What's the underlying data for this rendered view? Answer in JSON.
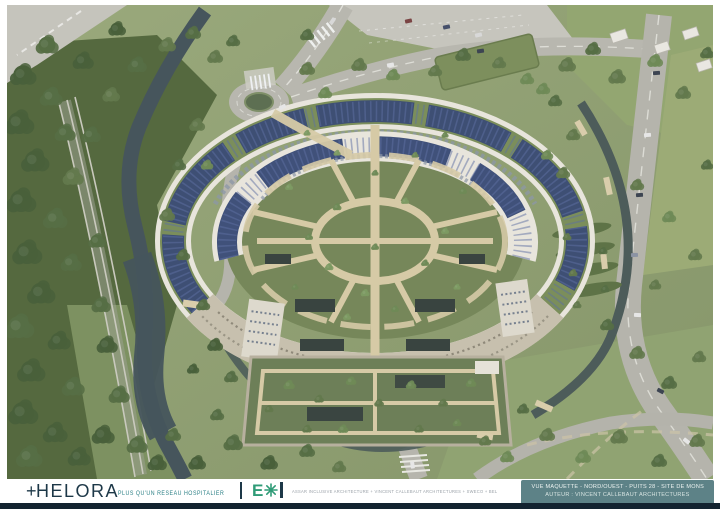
{
  "footer": {
    "helora": {
      "plus": "+",
      "name": "HELORA",
      "tagline": "PLUS QU'UN RÉSEAU HOSPITALIER"
    },
    "consortium": {
      "logo_e": "E",
      "logo_star_icon": "eight-spoke-star",
      "text": "ASSAR INCLUSIVE ARCHITECTURE + VINCENT CALLEBAUT ARCHITECTURES + SWECO + BEL"
    },
    "caption": {
      "line1": "VUE MAQUETTE - NORD/OUEST - PUITS 28 - SITE DE MONS",
      "line2": "AUTEUR : VINCENT CALLEBAUT ARCHITECTURES"
    }
  },
  "colors": {
    "caption_box": "#5d8287",
    "brand_navy": "#1d3848",
    "brand_teal": "#2a7f85",
    "logo_green": "#2f9b77",
    "bottom_bar": "#132330"
  }
}
